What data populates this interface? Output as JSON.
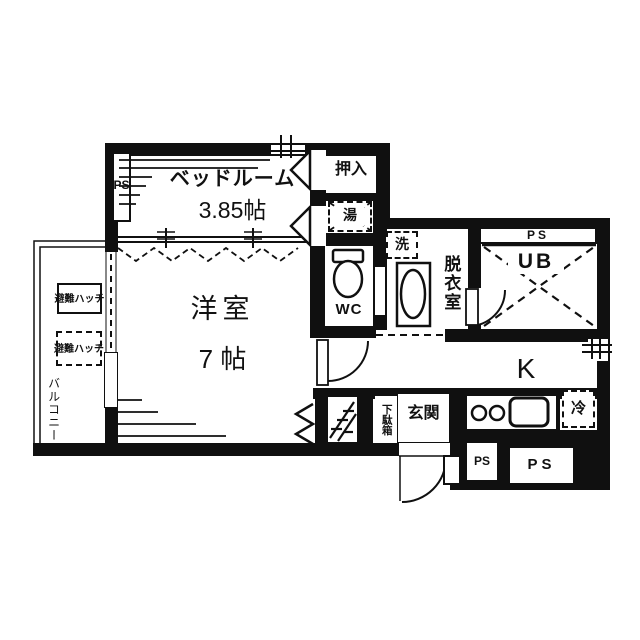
{
  "rooms": {
    "bedroom_name": "ベッドルーム",
    "bedroom_size": "3.85帖",
    "western_name": "洋室",
    "western_size": "7 帖",
    "oshiire": "押入",
    "water_heater": "湯",
    "washer": "洗",
    "dressing_room": "脱衣室",
    "unit_bath": "UB",
    "wc": "WC",
    "kitchen": "K",
    "fridge": "冷",
    "entrance": "玄関",
    "shoe_box": "下駄箱",
    "balcony": "バルコニー",
    "hatch_line1": "避難",
    "hatch_line2": "ハッチ"
  },
  "labels": {
    "ps": "PS",
    "p": "P",
    "s": "S"
  },
  "colors": {
    "ink": "#101010",
    "paper": "#ffffff"
  }
}
